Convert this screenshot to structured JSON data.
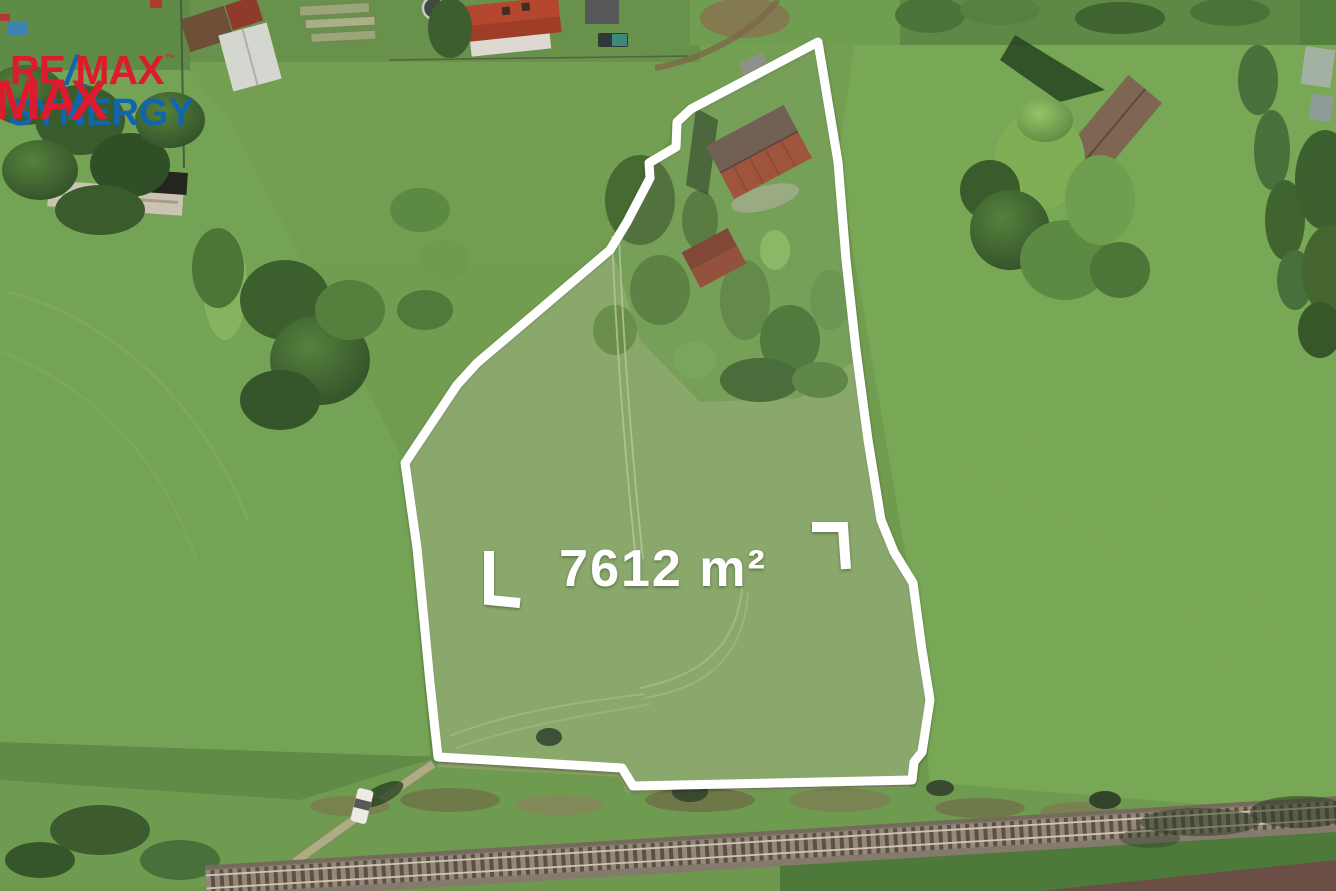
{
  "watermark": {
    "brand_re": "RE",
    "brand_slash": "/",
    "brand_max": "MAX",
    "trademark": "™",
    "overlay_ma": "MA",
    "overlay_slash": "/",
    "overlay_x": "X",
    "office_name": "SYNERGY",
    "colors": {
      "red": "#DC1C2E",
      "blue": "#1065B0"
    }
  },
  "plot": {
    "area_label": "7612 m²",
    "outline_color": "#FFFFFF",
    "label_color": "#FFFFFF"
  }
}
